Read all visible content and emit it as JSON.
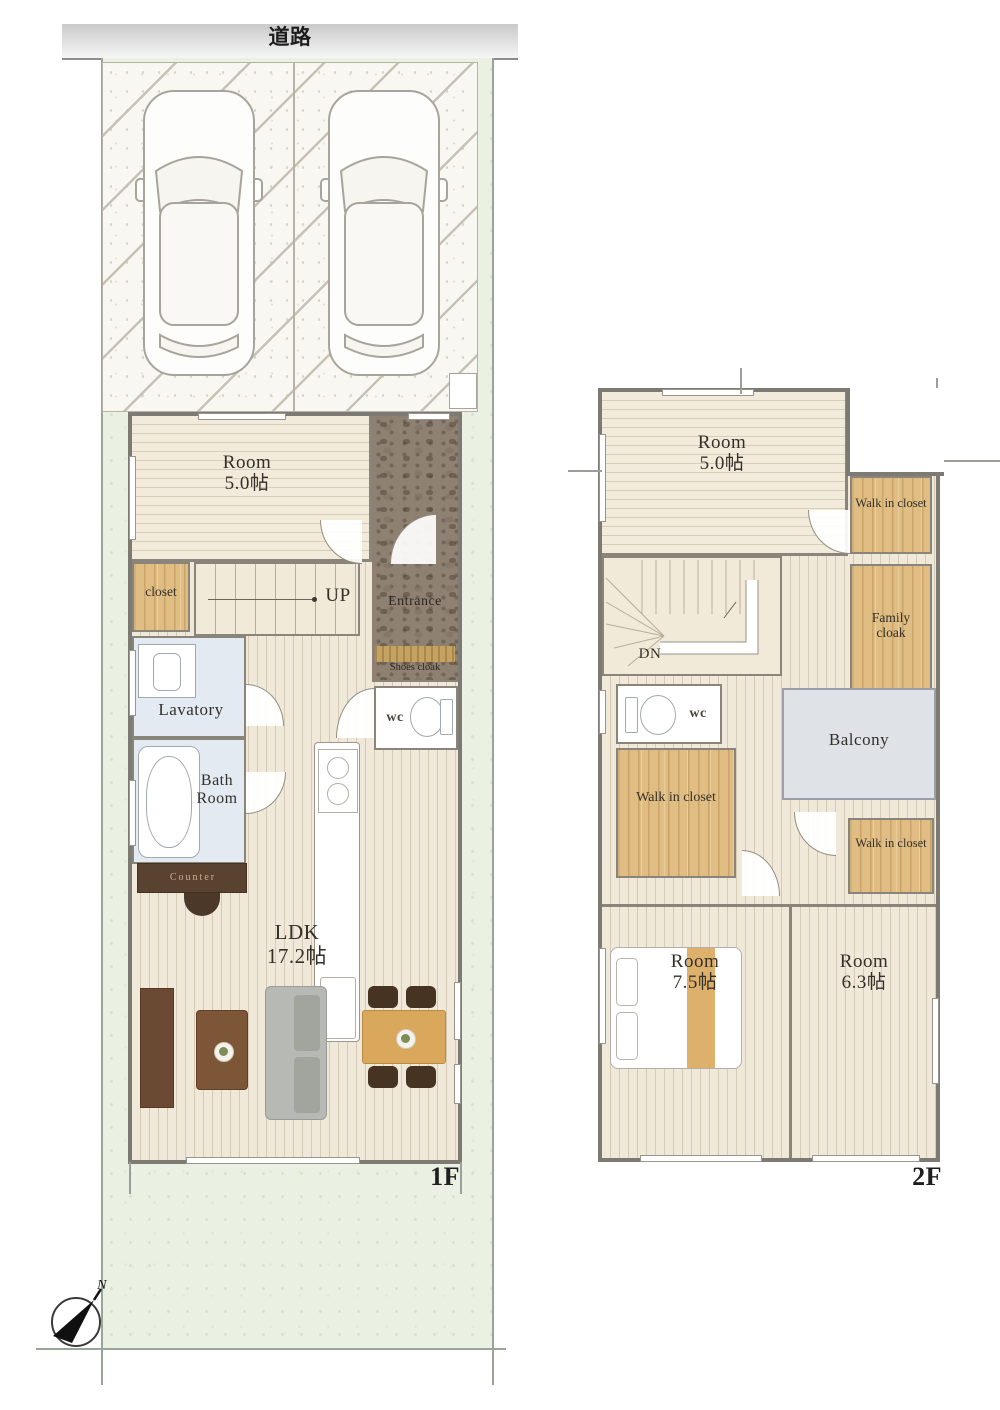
{
  "road": {
    "label": "道路"
  },
  "compass": {
    "north": "N"
  },
  "floor1": {
    "label": "1F",
    "room5": {
      "name": "Room",
      "size": "5.0帖"
    },
    "closet": "closet",
    "stairs": "UP",
    "entrance": "Entrance",
    "shoes_cloak": "Shoes cloak",
    "wc": "wc",
    "lavatory": "Lavatory",
    "bath": {
      "line1": "Bath",
      "line2": "Room"
    },
    "counter": "Counter",
    "ldk": {
      "name": "LDK",
      "size": "17.2帖"
    }
  },
  "floor2": {
    "label": "2F",
    "room5": {
      "name": "Room",
      "size": "5.0帖"
    },
    "walk_in_closet": "Walk in closet",
    "family_cloak": "Family cloak",
    "stairs": "DN",
    "wc": "wc",
    "balcony": "Balcony",
    "room75": {
      "name": "Room",
      "size": "7.5帖"
    },
    "room63": {
      "name": "Room",
      "size": "6.3帖"
    }
  },
  "colors": {
    "site_green": "#eaf0e2",
    "floor_cream": "#f0e9da",
    "hatch_line": "#d5cab6",
    "closet_wood": "#e0bd83",
    "water_blue": "#e3eaf2",
    "balcony_gray": "#dfe3e8",
    "entrance_brown": "#8f8171",
    "wall_gray": "#7d7973",
    "dark_furniture": "#5a4231",
    "dining_wood": "#d9a85c",
    "sofa_gray": "#b7bab4",
    "road_gray": "#d6d6d6"
  }
}
